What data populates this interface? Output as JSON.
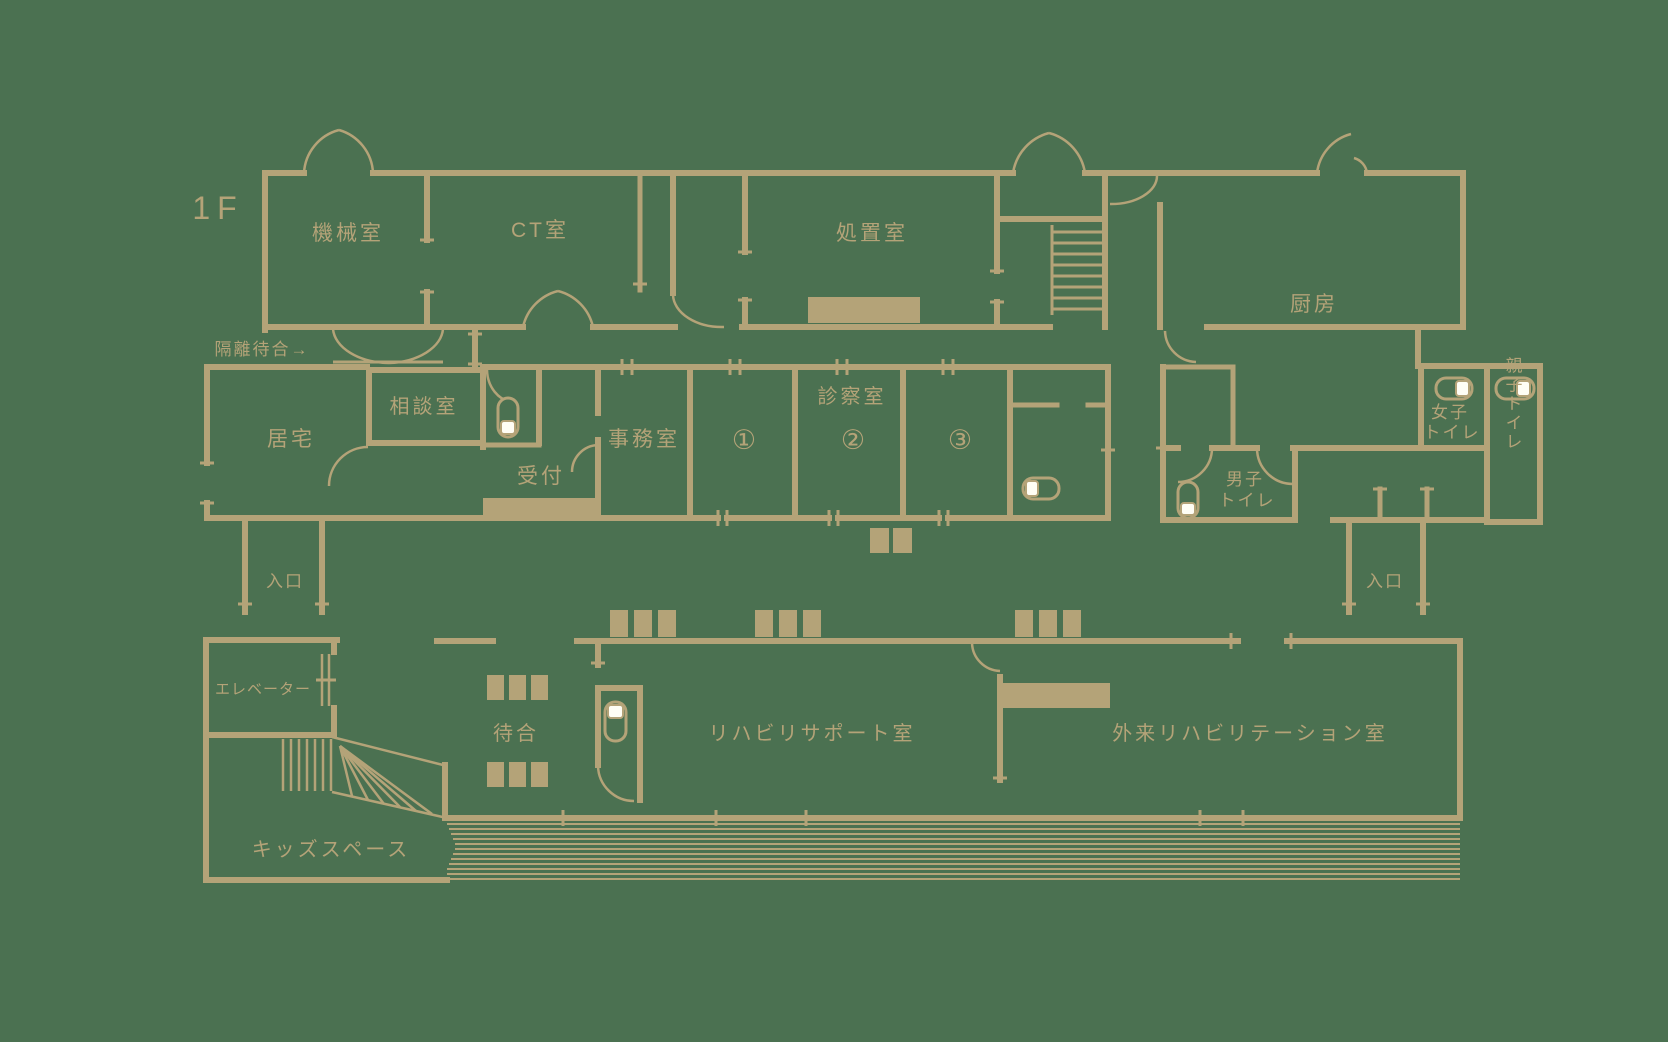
{
  "title": "1F clinic floor plan",
  "floor_label": "1F",
  "colors": {
    "background": "#4B7151",
    "line": "#B4A378",
    "fixture_white": "#FFFEF5"
  },
  "rooms": {
    "machine_room": "機械室",
    "ct_room": "CT室",
    "treatment_room": "処置室",
    "kitchen": "厨房",
    "isolation_waiting": "隔離待合→",
    "consultation_room": "相談室",
    "residence": "居宅",
    "reception": "受付",
    "office": "事務室",
    "exam_room": "診察室",
    "exam_room_1": "①",
    "exam_room_2": "②",
    "exam_room_3": "③",
    "womens_toilet_line1": "女子",
    "womens_toilet_line2": "トイレ",
    "family_toilet": "親子トイレ",
    "mens_toilet_line1": "男子",
    "mens_toilet_line2": "トイレ",
    "entrance_left": "入口",
    "entrance_right": "入口",
    "elevator": "エレベーター",
    "waiting": "待合",
    "kids_space": "キッズスペース",
    "rehab_support_room": "リハビリサポート室",
    "outpatient_rehab_room": "外来リハビリテーション室"
  }
}
